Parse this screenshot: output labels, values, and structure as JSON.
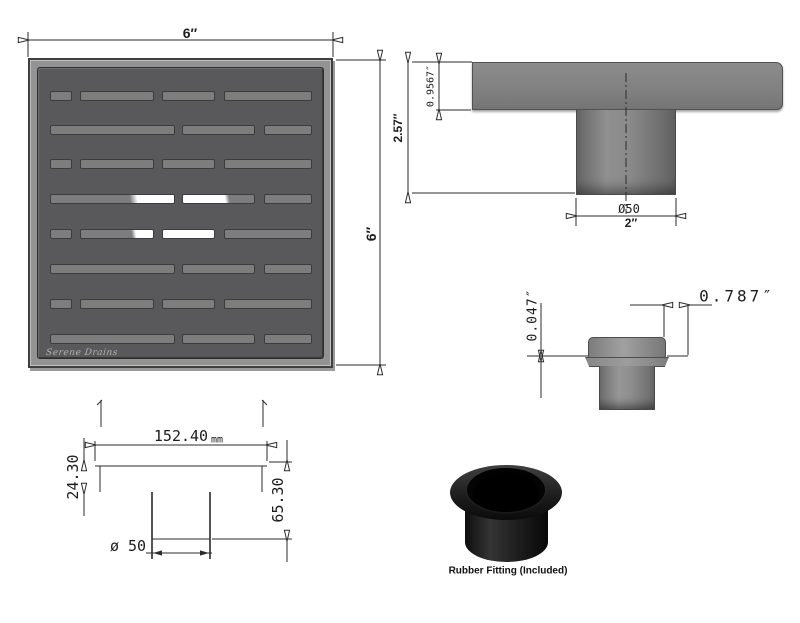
{
  "logo": "Serene Drains",
  "top_view": {
    "width": "6″",
    "height": "6″"
  },
  "side_view": {
    "total_height": "2.57″",
    "plate_height": "0.9567″",
    "pipe_diameter": "Ø50",
    "pipe_width": "2″"
  },
  "flange_detail": {
    "lip_height": "0.047″",
    "edge_offset": "0.787″"
  },
  "profile_view": {
    "width": "152.40",
    "width_unit": "mm",
    "flange_height": "24.30",
    "total_height": "65.30",
    "pipe_diameter": "ø 50"
  },
  "fitting": {
    "caption": "Rubber Fitting (Included)"
  },
  "colors": {
    "panel": "#59595b",
    "slot": "#7d7d7d",
    "slot_highlight": "#ffffff",
    "line": "#2b2b2b"
  },
  "grate": {
    "rows": [
      {
        "y": 31,
        "slots": [
          {
            "x": 20,
            "w": 22
          },
          {
            "x": 50,
            "w": 74
          },
          {
            "x": 132,
            "w": 53
          },
          {
            "x": 194,
            "w": 88
          }
        ]
      },
      {
        "y": 65,
        "slots": [
          {
            "x": 20,
            "w": 125
          },
          {
            "x": 152,
            "w": 73
          },
          {
            "x": 234,
            "w": 48
          }
        ]
      },
      {
        "y": 99,
        "slots": [
          {
            "x": 20,
            "w": 22
          },
          {
            "x": 50,
            "w": 74
          },
          {
            "x": 132,
            "w": 53
          },
          {
            "x": 194,
            "w": 88
          }
        ]
      },
      {
        "y": 134,
        "slots": [
          {
            "x": 20,
            "w": 125,
            "g": [
              67,
              100
            ]
          },
          {
            "x": 152,
            "w": 73,
            "g": [
              0,
              62
            ]
          },
          {
            "x": 234,
            "w": 48
          }
        ]
      },
      {
        "y": 169,
        "slots": [
          {
            "x": 20,
            "w": 22
          },
          {
            "x": 50,
            "w": 74,
            "g": [
              73,
              100
            ]
          },
          {
            "x": 132,
            "w": 53,
            "g": [
              0,
              100
            ]
          },
          {
            "x": 194,
            "w": 88
          }
        ]
      },
      {
        "y": 204,
        "slots": [
          {
            "x": 20,
            "w": 125
          },
          {
            "x": 152,
            "w": 73
          },
          {
            "x": 234,
            "w": 48
          }
        ]
      },
      {
        "y": 239,
        "slots": [
          {
            "x": 20,
            "w": 22
          },
          {
            "x": 50,
            "w": 74
          },
          {
            "x": 132,
            "w": 53
          },
          {
            "x": 194,
            "w": 88
          }
        ]
      },
      {
        "y": 274,
        "slots": [
          {
            "x": 20,
            "w": 125
          },
          {
            "x": 152,
            "w": 73
          },
          {
            "x": 234,
            "w": 48
          }
        ]
      }
    ]
  }
}
